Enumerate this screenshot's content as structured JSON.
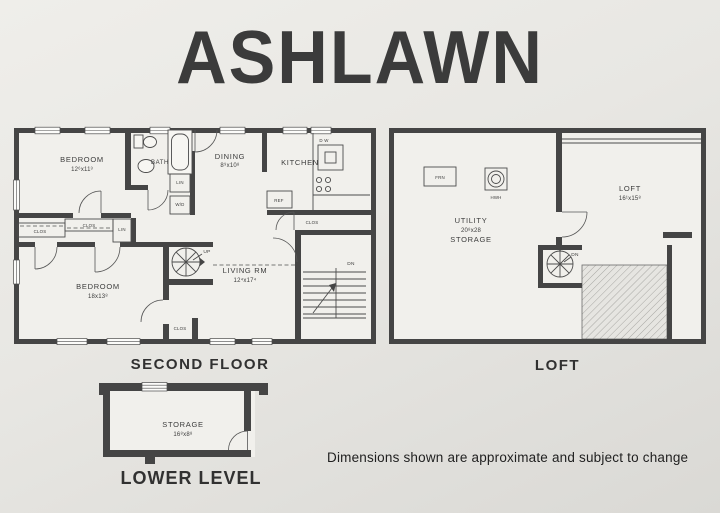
{
  "title": "ASHLAWN",
  "footnote": "Dimensions shown are approximate and subject to change",
  "colors": {
    "paper": "#e8e7e3",
    "wall": "#454545",
    "ink": "#3a3a3a"
  },
  "second_floor": {
    "section_label": "SECOND FLOOR",
    "rooms": {
      "bedroom1": {
        "name": "BEDROOM",
        "dims": "12⁶x11³"
      },
      "bath": {
        "name": "BATH"
      },
      "dining": {
        "name": "DINING",
        "dims": "8⁹x10⁸"
      },
      "kitchen": {
        "name": "KITCHEN"
      },
      "living": {
        "name": "LIVING RM",
        "dims": "12⁴x17⁴"
      },
      "bedroom2": {
        "name": "BEDROOM",
        "dims": "18x13⁸"
      }
    },
    "labels": {
      "lin_bath": "LIN",
      "wd": "W/D",
      "clos_hall_upper": "CLOS",
      "clos_hall_lower": "CLOS",
      "lin_hall": "LIN",
      "clos_kitchen": "CLOS",
      "clos_living": "CLOS",
      "up": "UP",
      "dn": "DN",
      "dw": "D W",
      "ref": "REF"
    }
  },
  "loft": {
    "section_label": "LOFT",
    "rooms": {
      "utility": {
        "name": "UTILITY",
        "dims": "20⁸x28",
        "name2": "STORAGE"
      },
      "loft_room": {
        "name": "LOFT",
        "dims": "16¹x15⁸"
      }
    },
    "labels": {
      "frn": "FRN",
      "hwh": "HWH",
      "dn": "DN"
    }
  },
  "lower_level": {
    "section_label": "LOWER LEVEL",
    "rooms": {
      "storage": {
        "name": "STORAGE",
        "dims": "16⁸x8⁸"
      }
    }
  }
}
